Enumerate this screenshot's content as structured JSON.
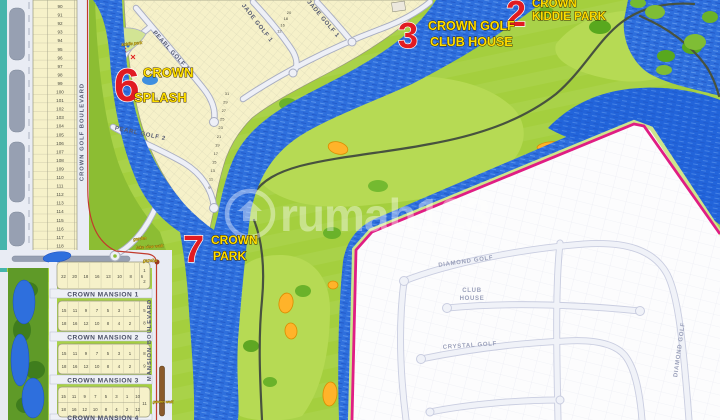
{
  "watermark": {
    "text": "rumah123"
  },
  "markers": {
    "kiddie_park": {
      "num": "2",
      "line1": "CROWN",
      "line2": "KIDDIE PARK"
    },
    "golf_club_house": {
      "num": "3",
      "line1": "CROWN GOLF",
      "line2": "CLUB HOUSE"
    },
    "splash": {
      "num": "6",
      "line1": "CROWN",
      "line2": "SPLASH"
    },
    "park": {
      "num": "7",
      "line1": "CROWN",
      "line2": "PARK"
    }
  },
  "streets": {
    "crown_golf_boulevard": "CROWN GOLF BOULEVARD",
    "mansion_boulevard": "MANSION BOULEVARD",
    "pearl_golf_1": "PEARL GOLF 1",
    "pearl_golf_2": "PEARL GOLF 2",
    "jade_golf_1": "JADE GOLF 1",
    "diamond_golf": "DIAMOND GOLF",
    "crystal_golf": "CRYSTAL GOLF"
  },
  "club_house": {
    "line1": "CLUB",
    "line2": "HOUSE"
  },
  "small_labels": {
    "kiddie_park": "kiddie park",
    "garden": "garden",
    "lake_view_walk": "lake view walk",
    "gazebo": "gazebo",
    "garden_walk": "garden walk"
  },
  "mansion_blocks": [
    {
      "name": "CROWN MANSION 1",
      "row1": [
        22,
        20,
        18,
        16,
        13,
        10,
        8,
        6
      ],
      "row2": [],
      "side": [
        1,
        2
      ]
    },
    {
      "name": "CROWN MANSION 2",
      "row1": [
        15,
        11,
        9,
        7,
        5,
        3,
        1
      ],
      "row2": [
        18,
        16,
        12,
        10,
        8,
        4,
        2
      ],
      "side": [
        5,
        8
      ]
    },
    {
      "name": "CROWN MANSION 3",
      "row1": [
        15,
        11,
        9,
        7,
        5,
        3,
        1
      ],
      "row2": [
        18,
        16,
        12,
        10,
        8,
        4,
        2
      ],
      "side": [
        8,
        9
      ]
    },
    {
      "name": "CROWN MANSION 4",
      "row1": [
        15,
        11,
        9,
        7,
        5,
        3,
        1,
        10
      ],
      "row2": [
        18,
        16,
        12,
        10,
        8,
        4,
        2,
        12
      ],
      "side": [
        11
      ]
    }
  ],
  "left_lots": [
    90,
    91,
    92,
    93,
    94,
    95,
    96,
    97,
    98,
    99,
    100,
    101,
    102,
    103,
    104,
    105,
    106,
    107,
    108,
    109,
    110,
    111,
    112,
    113,
    114,
    115,
    116,
    117,
    118,
    119
  ],
  "pearl_lot_column": [
    31,
    29,
    27,
    25,
    23,
    21,
    19,
    17,
    15,
    13,
    11,
    9
  ],
  "splash_lot_row": [
    35,
    30,
    28,
    26,
    24,
    22,
    20
  ],
  "jade_lot_row": [
    20,
    18,
    16,
    12
  ],
  "colors": {
    "fairway": "#b6da54",
    "rough_green": "#a4cf3e",
    "water": "#2e6fdd",
    "sand": "#ffb32a",
    "boundary_magenta": "#e01d84",
    "marker_red": "#e11b22",
    "label_yellow": "#ffdf00"
  }
}
